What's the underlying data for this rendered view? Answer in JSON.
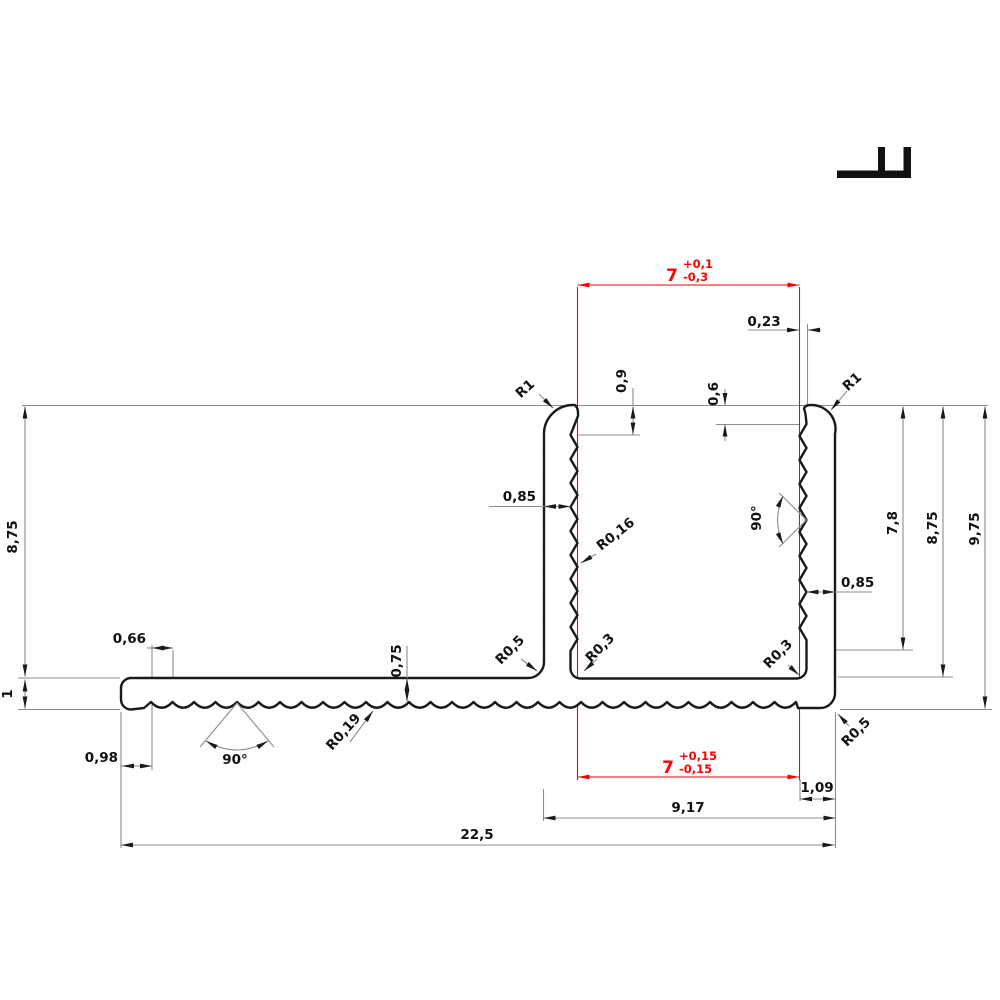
{
  "drawing": {
    "title": "aluminium-profile-cross-section",
    "colors": {
      "outline": "#1a1a1a",
      "dimension": "#8c8c8c",
      "tolerance": "#ff0000"
    },
    "labels": {
      "tol_top": {
        "value": "7",
        "plus": "+0,1",
        "minus": "-0,3"
      },
      "tol_bottom": {
        "value": "7",
        "plus": "+0,15",
        "minus": "-0,15"
      },
      "w023": "0,23",
      "h09": "0,9",
      "h06": "0,6",
      "r1_left": "R1",
      "r1_right": "R1",
      "w085_left": "0,85",
      "r016": "R0,16",
      "a90_right": "90°",
      "h78": "7,8",
      "h875_right": "8,75",
      "h975": "9,75",
      "w085_right": "0,85",
      "h875_left": "8,75",
      "h1": "1",
      "w066": "0,66",
      "h075": "0,75",
      "r05_left": "R0,5",
      "r03_left": "R0,3",
      "r03_right": "R0,3",
      "r05_right": "R0,5",
      "w098": "0,98",
      "a90_bottom": "90°",
      "r019": "R0,19",
      "w109": "1,09",
      "w917": "9,17",
      "w225": "22,5"
    }
  }
}
